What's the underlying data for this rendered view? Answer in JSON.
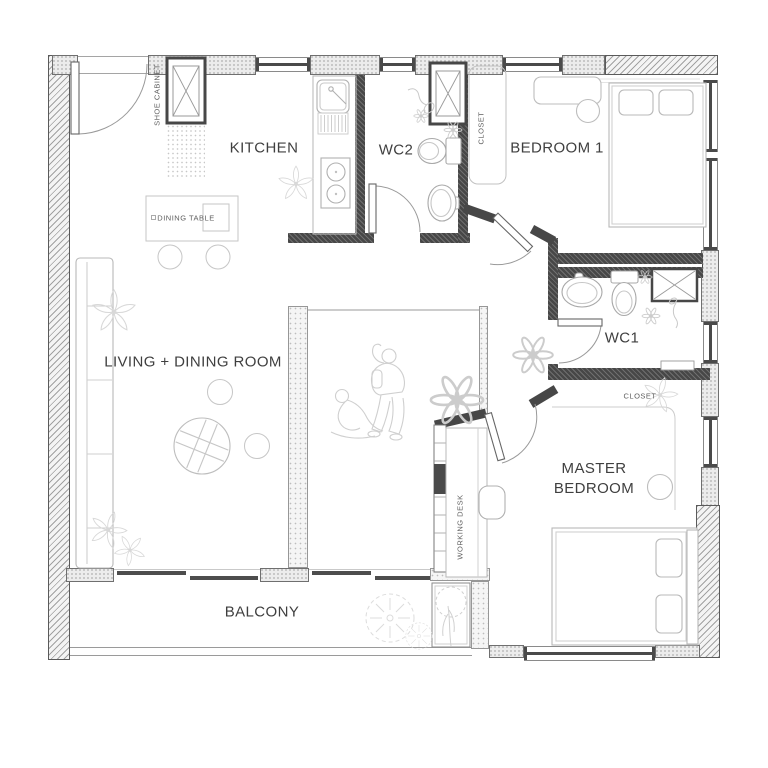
{
  "rooms": {
    "kitchen": "KITCHEN",
    "wc2": "WC2",
    "bedroom1": "BEDROOM 1",
    "living_dining": "LIVING + DINING ROOM",
    "wc1": "WC1",
    "master_line1": "MASTER",
    "master_line2": "BEDROOM",
    "balcony": "BALCONY"
  },
  "annotations": {
    "shoe_cabinet": "SHOE CABINET",
    "dining_table": "DINING TABLE",
    "closet_bedroom1": "CLOSET",
    "closet_master": "CLOSET",
    "working_desk": "WORKING DESK"
  },
  "colors": {
    "background": "#ffffff",
    "wall_dark": "#474747",
    "window_line": "#8a8a8a",
    "furniture_line": "#b8b8b8",
    "text": "#3f3f3f"
  }
}
